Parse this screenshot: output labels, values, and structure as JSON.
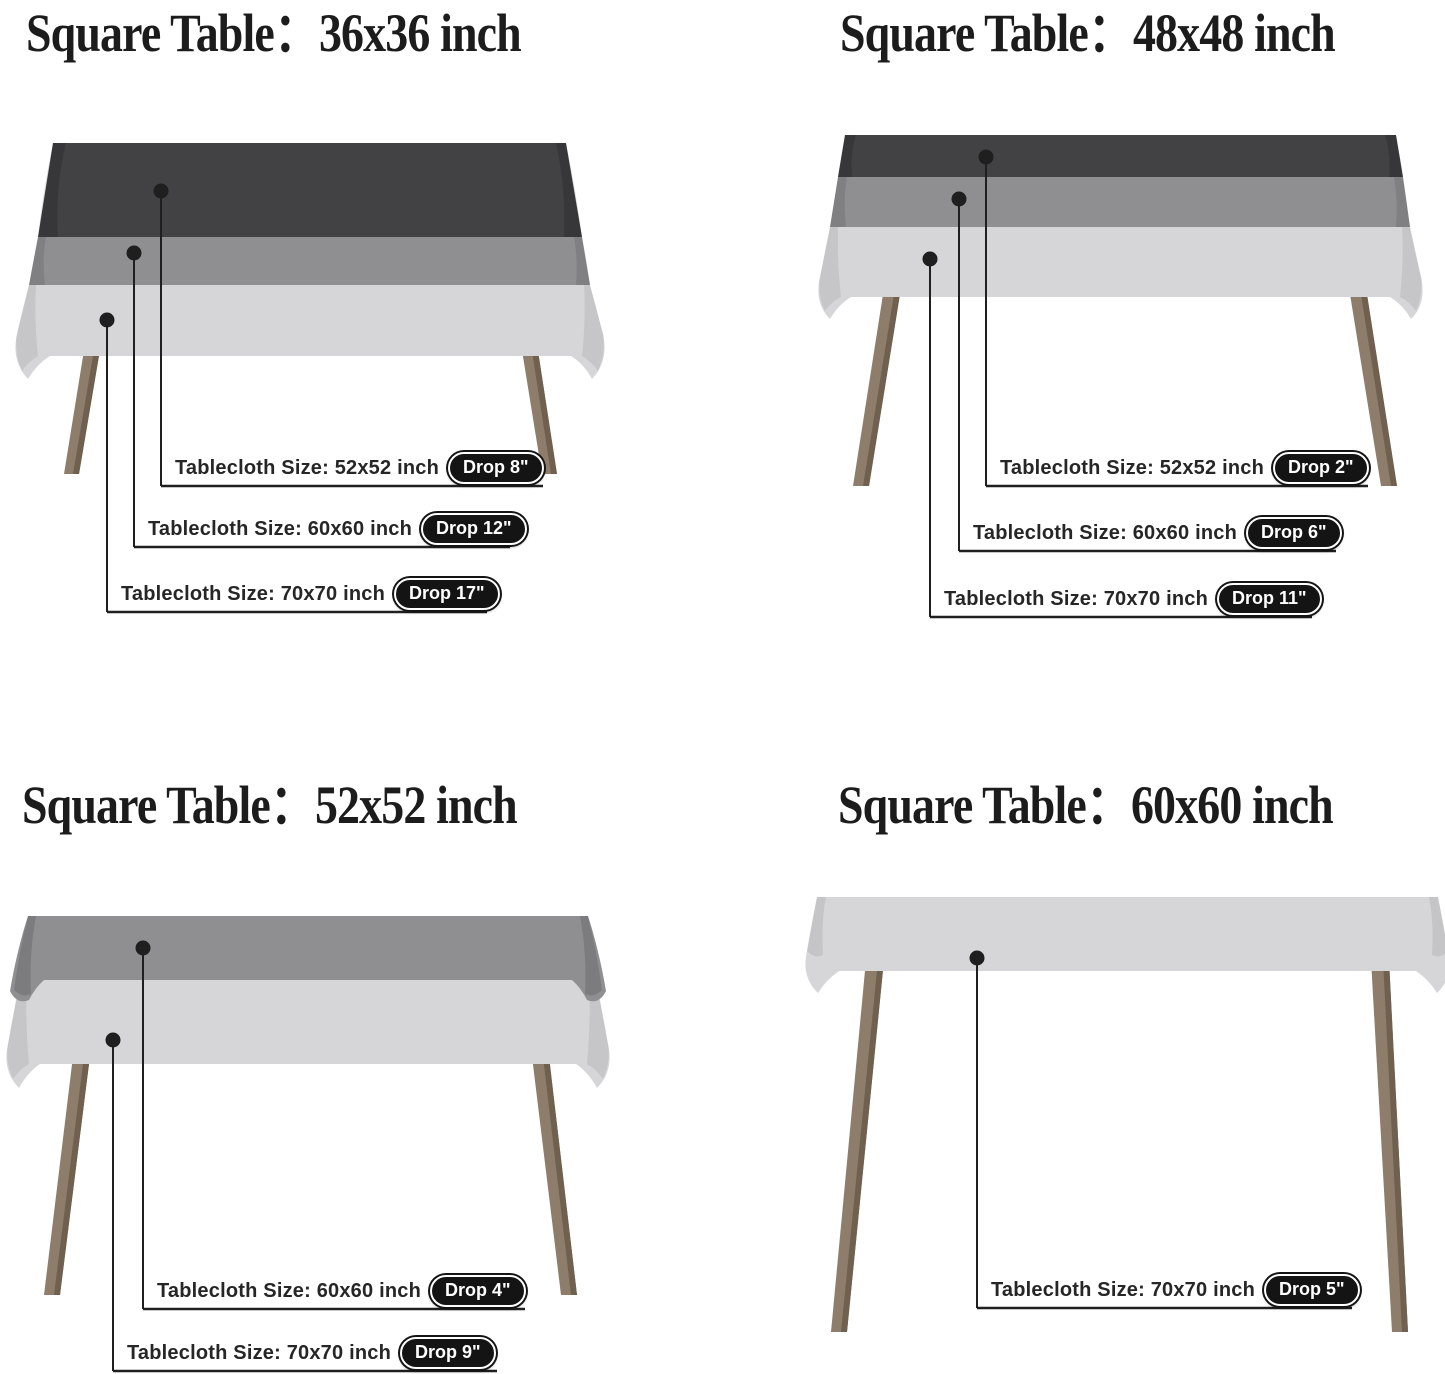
{
  "colors": {
    "cloth_dark": "#424244",
    "cloth_medium": "#8f8f91",
    "cloth_light": "#d6d6d8",
    "leg": "#8e7d6b",
    "leg_shade": "#6f604f",
    "line": "#1f1f1f",
    "badge_bg": "#141414",
    "badge_text": "#ffffff",
    "title_color": "#1c1c1c"
  },
  "panels": [
    {
      "title": "Square Table：36x36 inch",
      "callouts": [
        {
          "text": "Tablecloth Size: 52x52 inch",
          "badge": "Drop 8\""
        },
        {
          "text": "Tablecloth Size: 60x60 inch",
          "badge": "Drop 12\""
        },
        {
          "text": "Tablecloth Size: 70x70 inch",
          "badge": "Drop 17\""
        }
      ]
    },
    {
      "title": "Square Table：48x48 inch",
      "callouts": [
        {
          "text": "Tablecloth Size: 52x52 inch",
          "badge": "Drop 2\""
        },
        {
          "text": "Tablecloth Size: 60x60 inch",
          "badge": "Drop 6\""
        },
        {
          "text": "Tablecloth Size: 70x70 inch",
          "badge": "Drop 11\""
        }
      ]
    },
    {
      "title": "Square Table：52x52 inch",
      "callouts": [
        {
          "text": "Tablecloth Size: 60x60 inch",
          "badge": "Drop 4\""
        },
        {
          "text": "Tablecloth Size: 70x70 inch",
          "badge": "Drop 9\""
        }
      ]
    },
    {
      "title": "Square Table：60x60 inch",
      "callouts": [
        {
          "text": "Tablecloth Size: 70x70 inch",
          "badge": "Drop 5\""
        }
      ]
    }
  ]
}
